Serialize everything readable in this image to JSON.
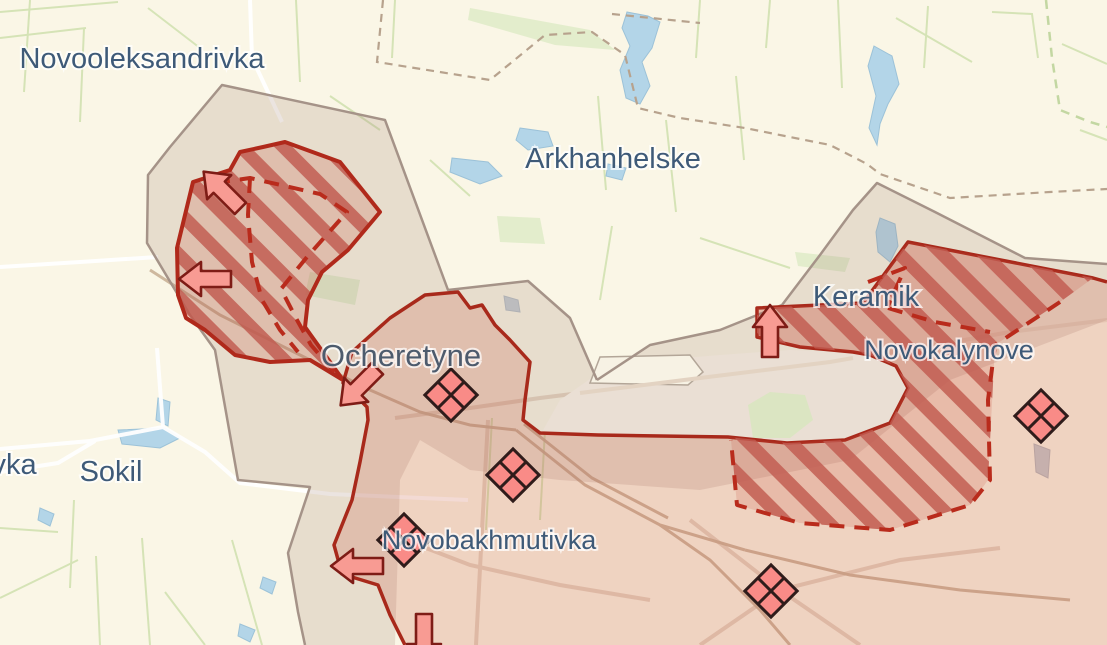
{
  "map": {
    "type": "conflict-frontline-map",
    "towns": [
      {
        "name": "Novooleksandrivka"
      },
      {
        "name": "Arkhanhelske"
      },
      {
        "name": "Ocheretyne"
      },
      {
        "name": "Keramik"
      },
      {
        "name": "Novokalynove"
      },
      {
        "name": "Sokil"
      },
      {
        "name": "Novobakhmutivka"
      },
      {
        "name": "vka"
      }
    ],
    "markers": {
      "clash_diamonds": [
        {
          "near": "Ocheretyne",
          "x": 451,
          "y": 395
        },
        {
          "near": "south of Ocheretyne",
          "x": 513,
          "y": 475
        },
        {
          "near": "Novobakhmutivka",
          "x": 404,
          "y": 540
        },
        {
          "near": "east of Novobakhmutivka",
          "x": 771,
          "y": 591
        },
        {
          "near": "Novokalynove",
          "x": 1041,
          "y": 416
        }
      ],
      "advance_arrows": [
        {
          "direction": "up-left",
          "x": 222,
          "y": 190
        },
        {
          "direction": "left",
          "x": 205,
          "y": 279
        },
        {
          "direction": "down-left",
          "x": 359,
          "y": 387
        },
        {
          "direction": "left",
          "x": 357,
          "y": 566
        },
        {
          "direction": "up",
          "x": 770,
          "y": 331
        },
        {
          "direction": "down",
          "x": 424,
          "y": 640
        }
      ]
    },
    "colors": {
      "background": "#faf6e6",
      "occupied_fill": "#f2d6cb",
      "occupied_border": "#a8291b",
      "advance_hatch_stripe": "#c05a50",
      "advance_dashed_border": "#b92b1c",
      "grey_zone_fill": "#e9dcd2",
      "grey_zone_border": "#a59388",
      "water": "#b3d5e8",
      "field_lines": "#cfe0ae",
      "town_label": "#3e5a78",
      "marker_fill": "#f89b93"
    }
  }
}
